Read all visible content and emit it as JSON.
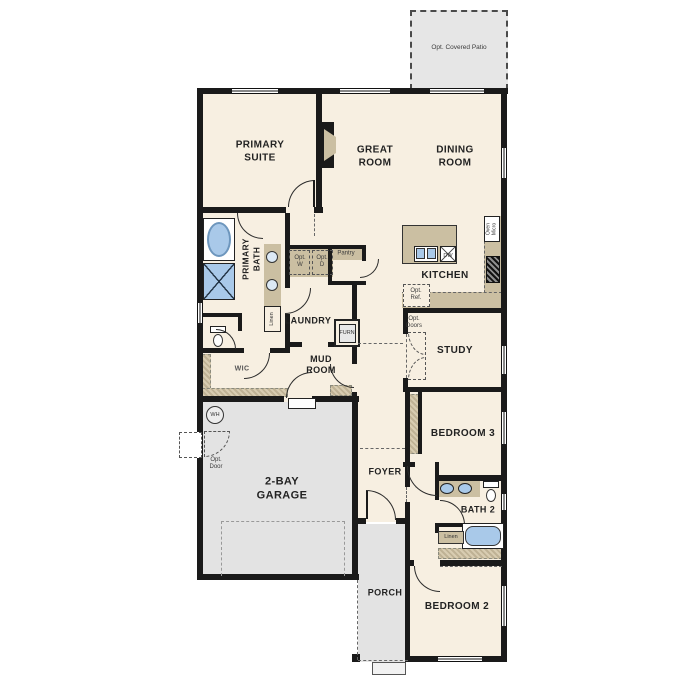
{
  "colors": {
    "wall": "#1a1a1a",
    "floor": "#f7efe1",
    "concrete": "#e3e3e3",
    "counter": "#cbbfa2",
    "fixture_blue": "#a9c9e9"
  },
  "rooms": {
    "patio": "Opt. Covered Patio",
    "primary_suite": "PRIMARY\nSUITE",
    "great_room": "GREAT\nROOM",
    "dining_room": "DINING\nROOM",
    "kitchen": "KITCHEN",
    "primary_bath": "PRIMARY\nBATH",
    "laundry": "LAUNDRY",
    "pantry": "Pantry",
    "wic": "WIC",
    "mud_room": "MUD\nROOM",
    "study": "STUDY",
    "bedroom3": "BEDROOM 3",
    "foyer": "FOYER",
    "garage": "2-BAY\nGARAGE",
    "bath2": "BATH 2",
    "bedroom2": "BEDROOM 2",
    "porch": "PORCH"
  },
  "annotations": {
    "opt_w": "Opt.\nW",
    "opt_d": "Opt.\nD",
    "opt_ref": "Opt.\nRef.",
    "opt_doors": "Opt.\nDoors",
    "opt_door": "Opt.\nDoor",
    "furn": "FURN",
    "wh": "WH",
    "dw": "DW",
    "oven_micro": "Oven\nMicro",
    "linen_bath_hall": "Linen",
    "linen_bath2": "Linen"
  }
}
